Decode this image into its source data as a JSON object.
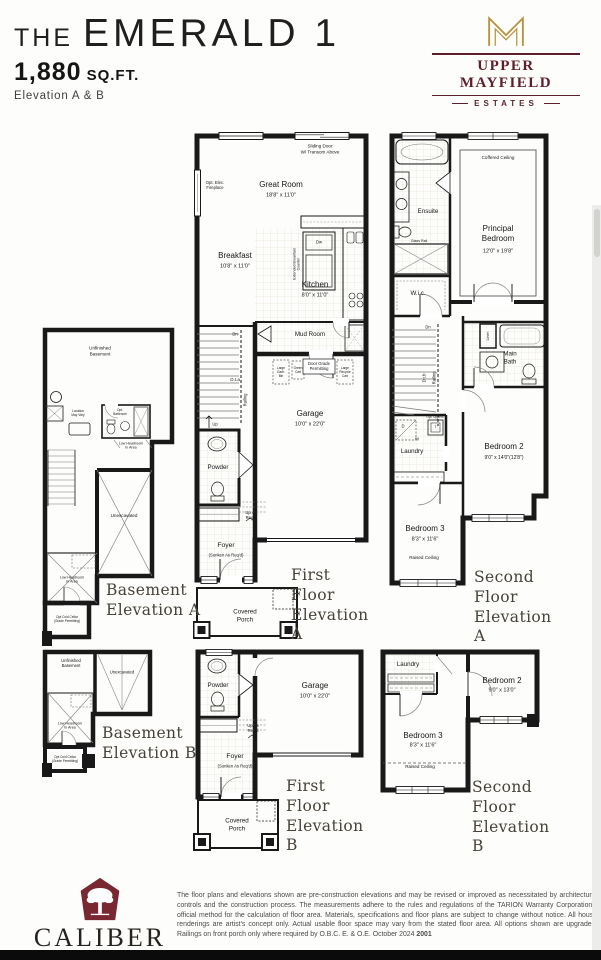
{
  "page": {
    "bg": "#fdfdfb",
    "wall_color": "#191919",
    "maroon": "#5e1e2b",
    "gold": "#b8923e"
  },
  "header": {
    "title_the": "THE",
    "title_name": "EMERALD 1",
    "sqft": "1,880",
    "sqft_unit": "SQ.FT.",
    "elevation": "Elevation A & B"
  },
  "brand": {
    "name": "UPPER MAYFIELD",
    "sub": "ESTATES"
  },
  "plans": {
    "ffa": {
      "caption": "First Floor\nElevation A",
      "sliding_door": "Sliding Door\nW/ Transom Above",
      "opt_fireplace": "Opt. Elec.\nFireplace",
      "great_room": "Great Room",
      "great_room_dim": "18'8\" x 11'0\"",
      "breakfast": "Breakfast",
      "breakfast_dim": "10'8\" x 11'0\"",
      "ext_counter": "Extended Breakfast\nCounter",
      "dw": "Dw",
      "kitchen": "Kitchen",
      "kitchen_dim": "8'0\" x 11'0\"",
      "mud_room": "Mud Room",
      "door_grade": "Door Grade\nPermitting",
      "garb_bin": "Large\nGarb.\nBin",
      "green_cart": "Green\nCart",
      "recycle_cart": "Large\nRecycle\nCart",
      "garage": "Garage",
      "garage_dim": "10'0\" x 22'0\"",
      "dn": "Dn",
      "ota": "O.t.a",
      "railing": "Railing",
      "up": "Up",
      "powder": "Powder",
      "up_req": "Up As\nReq'd",
      "foyer": "Foyer",
      "foyer_sub": "(Sunken As Req'd)",
      "porch": "Covered\nPorch"
    },
    "sfa": {
      "caption": "Second Floor\nElevation A",
      "ensuite": "Ensuite",
      "glass_rail": "Glass Rail",
      "coffered": "Coffered Ceiling",
      "principal": "Principal\nBedroom",
      "principal_dim": "12'0\" x 19'8\"",
      "wic": "W.i.c.",
      "dn": "Dn",
      "dtb": "D.t.b",
      "railing": "Railing",
      "linen": "Linen",
      "main_bath": "Main\nBath",
      "opt_uppers": "Opt. Uppers",
      "d": "D",
      "w": "W",
      "t": "T",
      "laundry": "Laundry",
      "bed2": "Bedroom 2",
      "bed2_dim": "9'0\" x 14'0\"(12'8\")",
      "bed3": "Bedroom 3",
      "bed3_dim": "8'3\" x 11'6\"",
      "raised": "Raised Ceiling"
    },
    "bsa": {
      "caption": "Basement\nElevation A",
      "unfinished": "Unfinished\nBasement",
      "loc_vary": "Location\nMay Vary",
      "opt_bath": "Opt.\nBathroom",
      "low_head1": "Low Headroom\nIn Area",
      "unexcavated": "Unexcavated",
      "low_head2": "Low Headroom\nIn Area",
      "cold_cellar": "Opt Cold Cellar\n(Grade Permitting)"
    },
    "bsb": {
      "caption": "Basement\nElevation B",
      "unfinished": "Unfinished\nBasement",
      "unexcavated": "Unexcavated",
      "low_head": "Low Headroom\nIn Area",
      "cold_cellar": "Opt Cold Cellar\n(Grade Permitting)"
    },
    "ffb": {
      "caption": "First Floor\nElevation B",
      "powder": "Powder",
      "garage": "Garage",
      "garage_dim": "10'0\" x 22'0\"",
      "up_req": "Up As\nReq'd",
      "foyer": "Foyer",
      "foyer_sub": "(Sunken As Req'd)",
      "porch": "Covered\nPorch"
    },
    "sfb": {
      "caption": "Second Floor\nElevation B",
      "laundry": "Laundry",
      "bed2": "Bedroom 2",
      "bed2_dim": "9'0\" x 13'0\"",
      "bed3": "Bedroom 3",
      "bed3_dim": "8'3\" x 11'6\"",
      "raised": "Raised Ceiling"
    }
  },
  "footer": {
    "builder": "CALIBER",
    "builder_sub": "HOMES",
    "disclaimer": "The floor plans and elevations shown are pre-construction elevations and may be revised or improved as necessitated by architectural controls and the construction process.  The measurements adhere to the rules and regulations of the TARION Warranty Corporation's official method for the calculation of floor area.  Materials, specifications and floor plans are subject to change without notice.  All house renderings are artist's concept only.  Actual usable floor space may vary from the stated floor area.  All options shown are upgrades. Railings on front porch only where required by O.B.C.  E. & O.E.  October 2024 ",
    "code": "2001"
  }
}
